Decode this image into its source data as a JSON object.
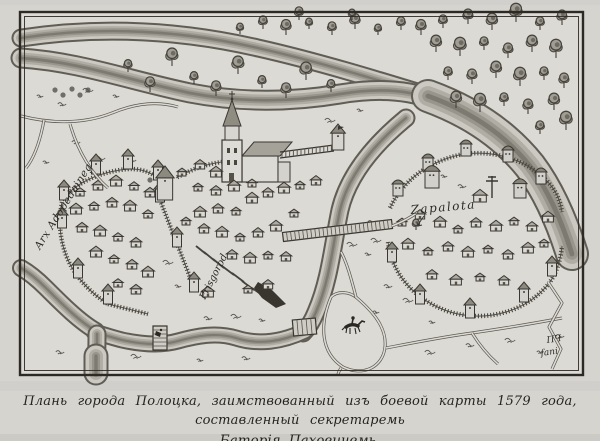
{
  "caption": {
    "line1": "Плань города Полоцка, заимствованный изъ боевой карты 1579 года, составленный секретаремь",
    "line2": "Баторія Паховичемь."
  },
  "map": {
    "labels": [
      {
        "id": "arx-inscription",
        "text": "Arx Adopedaineg"
      },
      {
        "id": "prisgorod-inscription",
        "text": "Prisgorod"
      },
      {
        "id": "zapalota-inscription",
        "text": "Zapalota"
      },
      {
        "id": "engraver-monogram-line1",
        "text": "ПЧ"
      },
      {
        "id": "engraver-monogram-line2",
        "text": "fani"
      }
    ]
  },
  "colors": {
    "paper": "#d6d4cf",
    "map_paper": "#dcdad5",
    "ink": "#3a3732",
    "water_edge": "#605d55",
    "water_light": "#ccc9c2",
    "foliage": "#a09d94"
  }
}
